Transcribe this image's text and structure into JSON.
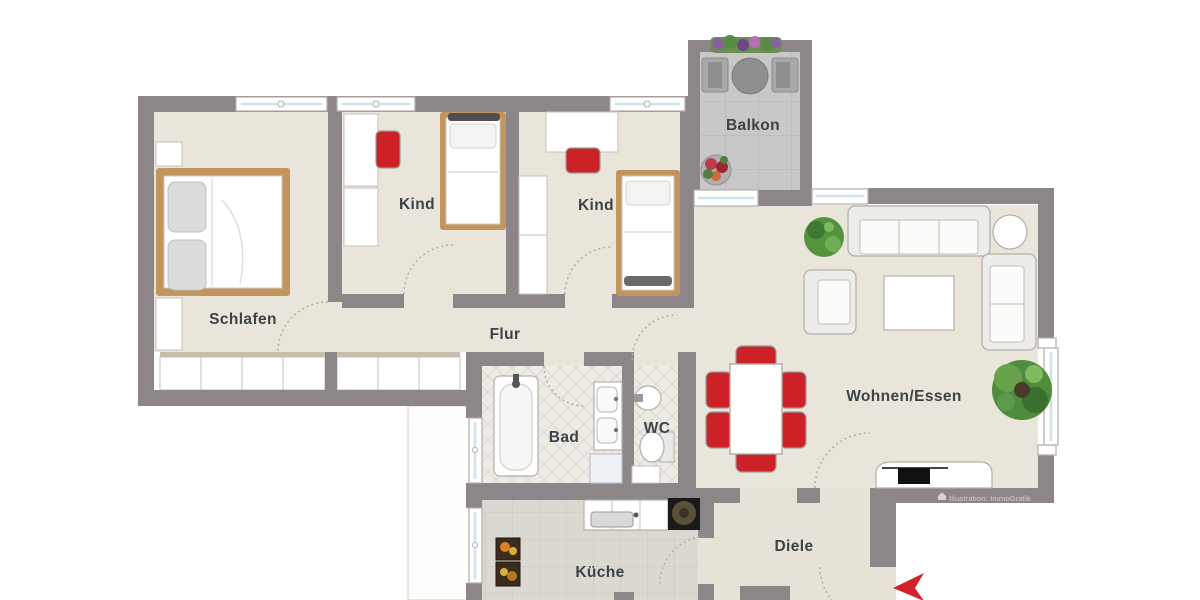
{
  "rooms": {
    "schlafen": {
      "label": "Schlafen"
    },
    "kind1": {
      "label": "Kind"
    },
    "kind2": {
      "label": "Kind"
    },
    "flur": {
      "label": "Flur"
    },
    "bad": {
      "label": "Bad"
    },
    "wc": {
      "label": "WC"
    },
    "kueche": {
      "label": "Küche"
    },
    "diele": {
      "label": "Diele"
    },
    "wohnen": {
      "label": "Wohnen/Essen"
    },
    "balkon": {
      "label": "Balkon"
    }
  },
  "watermark": {
    "text": "Illustration: ImmoGrafik"
  },
  "colors": {
    "wall": "#8d8689",
    "floor": "#eae5da",
    "diele_floor": "#e7e2d7",
    "kitchen_floor": "#dbd8d2",
    "tile_floor": "#edebe4",
    "balcony_floor": "#c8c8c8",
    "bed_frame": "#c2945e",
    "accent_red": "#cc2127",
    "plant_green": "#4f8c3d",
    "label": "#3c4248",
    "window_glass": "#cfe3e8"
  }
}
